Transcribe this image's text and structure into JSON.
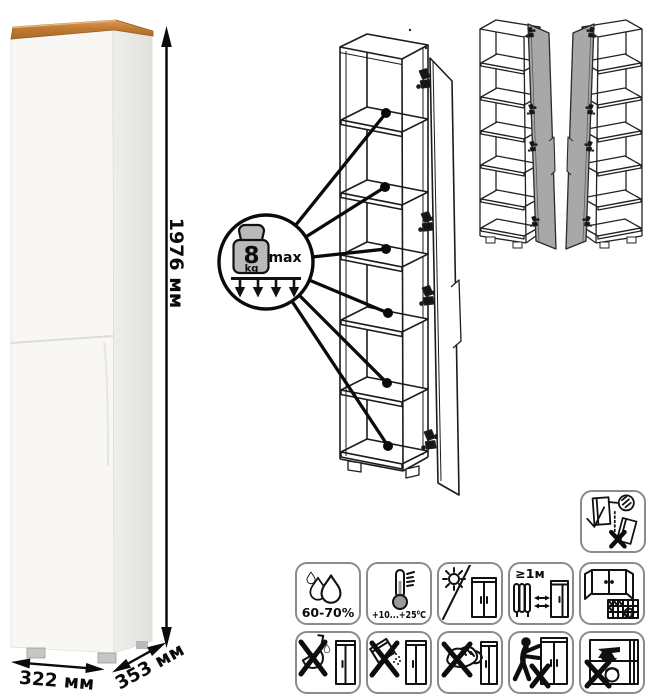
{
  "product_figure": {
    "dimensions": {
      "height": "1976 мм",
      "width": "322 мм",
      "depth": "353 мм"
    },
    "load_limit": {
      "value": "8",
      "unit": "kg",
      "qualifier": "max"
    }
  },
  "care_icons": {
    "wall_anchor": {
      "name": "anchor-to-wall-warning"
    },
    "row1": [
      {
        "name": "humidity-range",
        "label": "60-70%"
      },
      {
        "name": "temperature-range",
        "label": "+10...+25⁰C"
      },
      {
        "name": "no-direct-sunlight",
        "label": ""
      },
      {
        "name": "heat-source-distance",
        "label": "≥1м"
      },
      {
        "name": "ventilate-room",
        "label": "21"
      }
    ],
    "row2": [
      {
        "name": "no-harsh-liquids"
      },
      {
        "name": "no-abrasive-powder"
      },
      {
        "name": "no-abrasive-scrubbing"
      },
      {
        "name": "no-dragging"
      },
      {
        "name": "no-overloading"
      }
    ]
  },
  "colors": {
    "wood": "#c07a33",
    "line_art": "#111111",
    "door_gray": "#a8a8a8",
    "icon_border": "#8b8b8b"
  }
}
